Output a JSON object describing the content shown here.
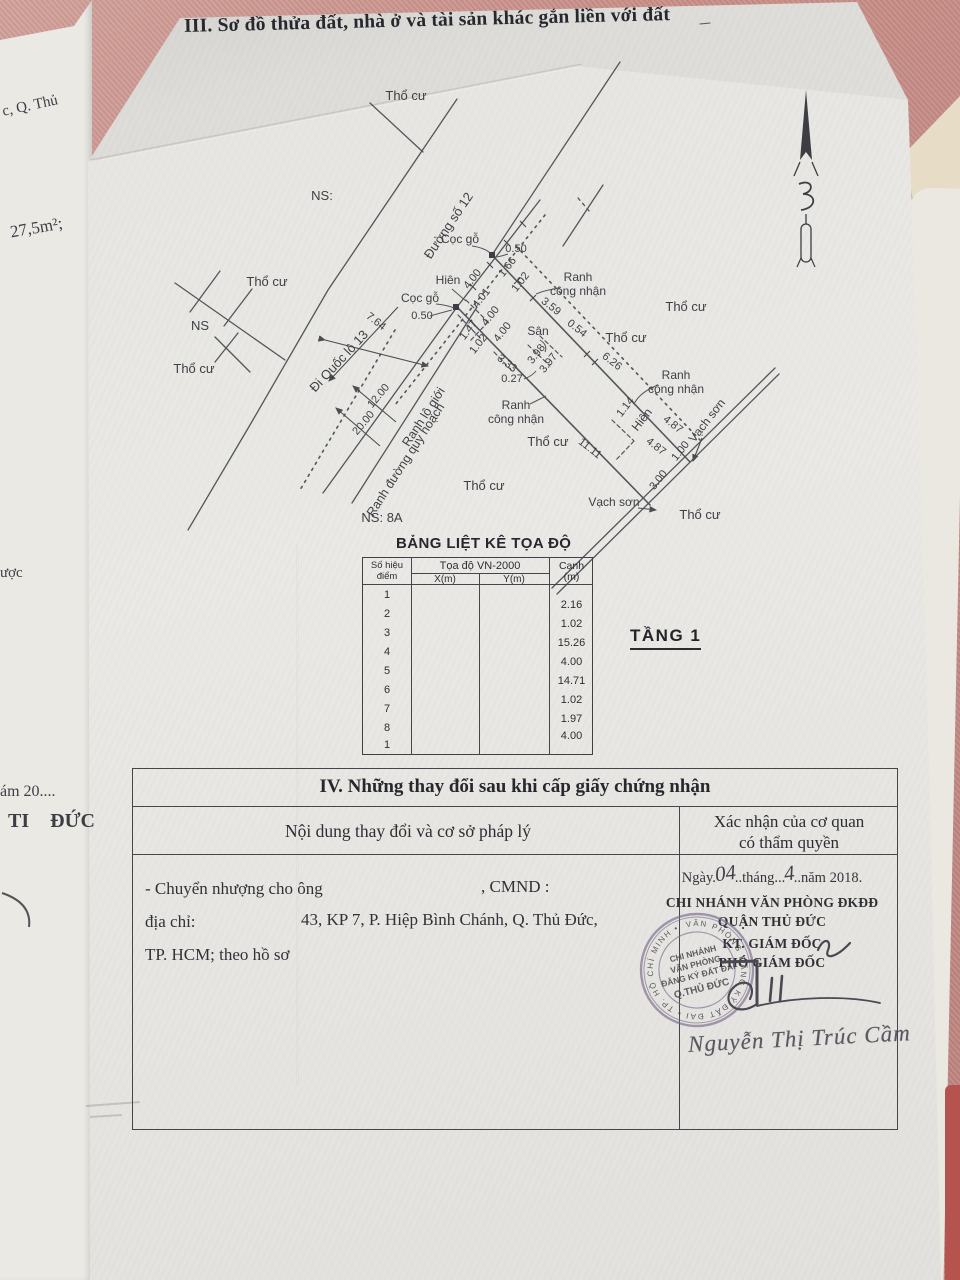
{
  "title3": "III. Sơ đồ thửa đất, nhà ở và tài sản khác gắn liền với đất",
  "left_margin": {
    "l1": "c, Q. Thủ",
    "l2": "27,5m²;",
    "l3": "ược",
    "l4": "ám 20....",
    "l5": "TI ĐỨC"
  },
  "diagram": {
    "labels": {
      "tho_cu": "Thổ cư",
      "ns": "NS:",
      "ns_plain": "NS",
      "ns_8a": "NS: 8A",
      "duong_so_12": "Đường số 12",
      "di_quoc_lo_13": "Đi Quốc lộ 13",
      "coc_go": "Cọc gỗ",
      "hien": "Hiên",
      "san": "Sân",
      "ranh": "Ranh",
      "cong_nhan": "công nhận",
      "ranh_lo_gioi": "Ranh lộ giới",
      "ranh_duong_quy_hoach": "Ranh đường quy hoạch",
      "vach_son": "Vạch sơn"
    },
    "dims": {
      "d050": "0.50",
      "d764": "7.64",
      "d1200": "12.00",
      "d2000": "20.00",
      "d400": "4.00",
      "d401": "4.01",
      "d166": "1.66",
      "d102": "1.02",
      "d147": "1.47",
      "d333": "3.33",
      "d027": "0.27",
      "d398": "3.98",
      "d397": "3.97",
      "d359": "3.59",
      "d054": "0.54",
      "d626": "6.26",
      "d1111": "11.11",
      "d114": "1.14",
      "d487": "4.87",
      "d100": "1.00",
      "d300": "3.00"
    }
  },
  "coord_table": {
    "title": "BẢNG LIỆT KÊ TỌA ĐỘ",
    "col_point_l1": "Số hiệu",
    "col_point_l2": "điểm",
    "col_coord": "Tọa độ VN-2000",
    "col_x": "X(m)",
    "col_y": "Y(m)",
    "col_edge_l1": "Cạnh",
    "col_edge_l2": "(m)",
    "points": [
      "1",
      "2",
      "3",
      "4",
      "5",
      "6",
      "7",
      "8",
      "1"
    ],
    "edges": [
      "2.16",
      "1.02",
      "15.26",
      "4.00",
      "14.71",
      "1.02",
      "1.97",
      "4.00"
    ]
  },
  "floor_label": "TẦNG 1",
  "section4": {
    "title": "IV. Những thay đổi sau khi cấp giấy chứng nhận",
    "col1": "Nội dung thay đổi và cơ sở pháp lý",
    "col2_l1": "Xác nhận của cơ quan",
    "col2_l2": "có thẩm quyền",
    "body_l1a": "- Chuyển nhượng cho ông",
    "body_l1b": ", CMND :",
    "body_l2a": "địa chỉ:",
    "body_l2b": "43, KP 7, P. Hiệp Bình Chánh, Q. Thủ Đức,",
    "body_l3": "TP. HCM; theo hồ sơ",
    "date": {
      "p1": "Ngày.",
      "hw_day": "04",
      "p2": "..tháng...",
      "hw_month": "4",
      "p3": "..năm 2018."
    },
    "org1": "CHI NHÁNH VĂN PHÒNG ĐKĐĐ",
    "org2": "QUẬN THỦ ĐỨC",
    "role1": "KT. GIÁM ĐỐC",
    "role2": "PHÓ GIÁM ĐỐC",
    "signer": "Nguyễn Thị Trúc Cầm"
  },
  "stamp": {
    "ring": "VĂN PHÒNG ĐĂNG KÝ ĐẤT ĐAI • TP. HỒ CHÍ MINH •",
    "c1": "CHI NHÁNH",
    "c2": "VĂN PHÒNG",
    "c3": "ĐĂNG KÝ ĐẤT ĐAI",
    "c4": "Q.THỦ ĐỨC"
  }
}
